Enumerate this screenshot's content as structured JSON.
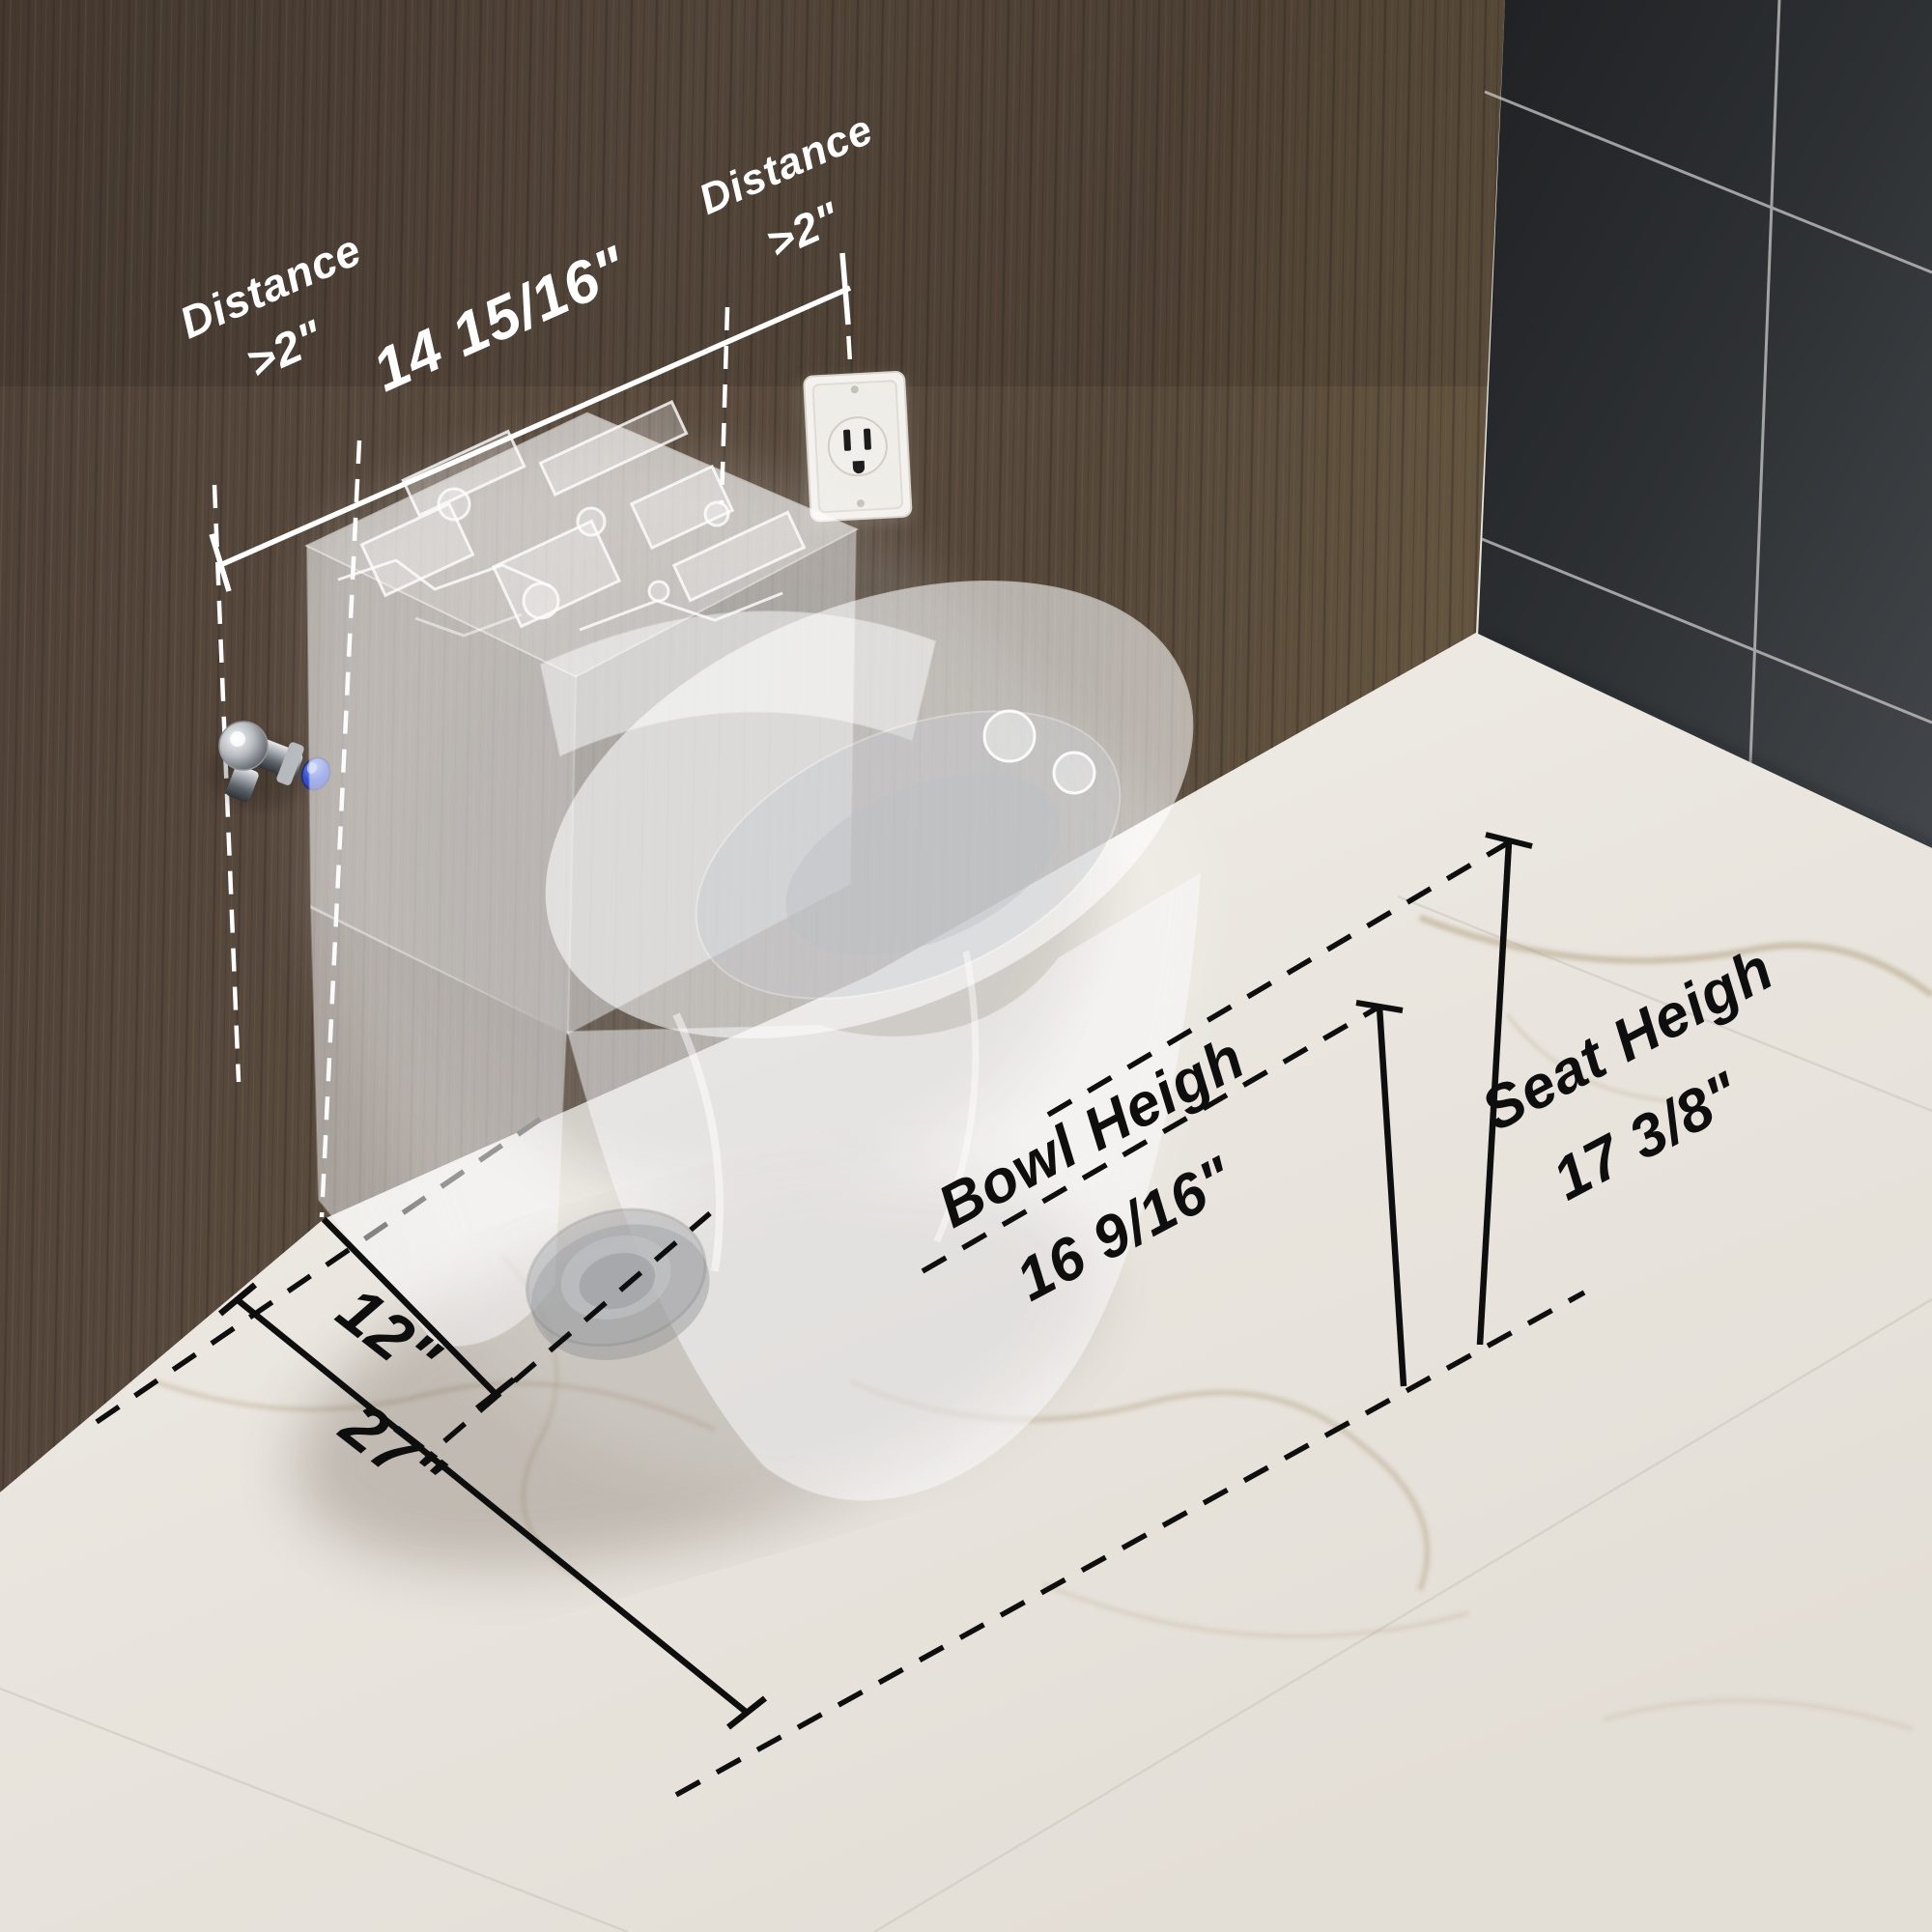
{
  "image": {
    "type": "product dimension diagram",
    "subject": "smart toilet shown translucent in a bathroom corner with installation clearance dimensions"
  },
  "labels": {
    "left_clearance": {
      "title": "Distance",
      "value": ">2\""
    },
    "tank_width": {
      "value": "14 15/16\""
    },
    "right_clearance": {
      "title": "Distance",
      "value": ">2\""
    },
    "rough_in": {
      "value": "12\""
    },
    "total_depth": {
      "value": "27\""
    },
    "bowl_height": {
      "title": "Bowl Heigh",
      "value": "16 9/16\""
    },
    "seat_height": {
      "title": "Seat Heigh",
      "value": "17 3/8\""
    }
  },
  "objects": {
    "water_valve": "chrome angle valve with blue cap on wood wall",
    "power_outlet": "white single electrical outlet on wood wall",
    "toilet": "translucent x-ray render of one-piece smart toilet with drain ring"
  },
  "colors": {
    "wood_wall": "#57493d",
    "tile_wall": "#2b2d2f",
    "marble_floor": "#ece8e2",
    "dimension_white": "#ffffff",
    "dimension_black": "#0e0e0e",
    "valve_cap_blue": "#2947d1"
  }
}
